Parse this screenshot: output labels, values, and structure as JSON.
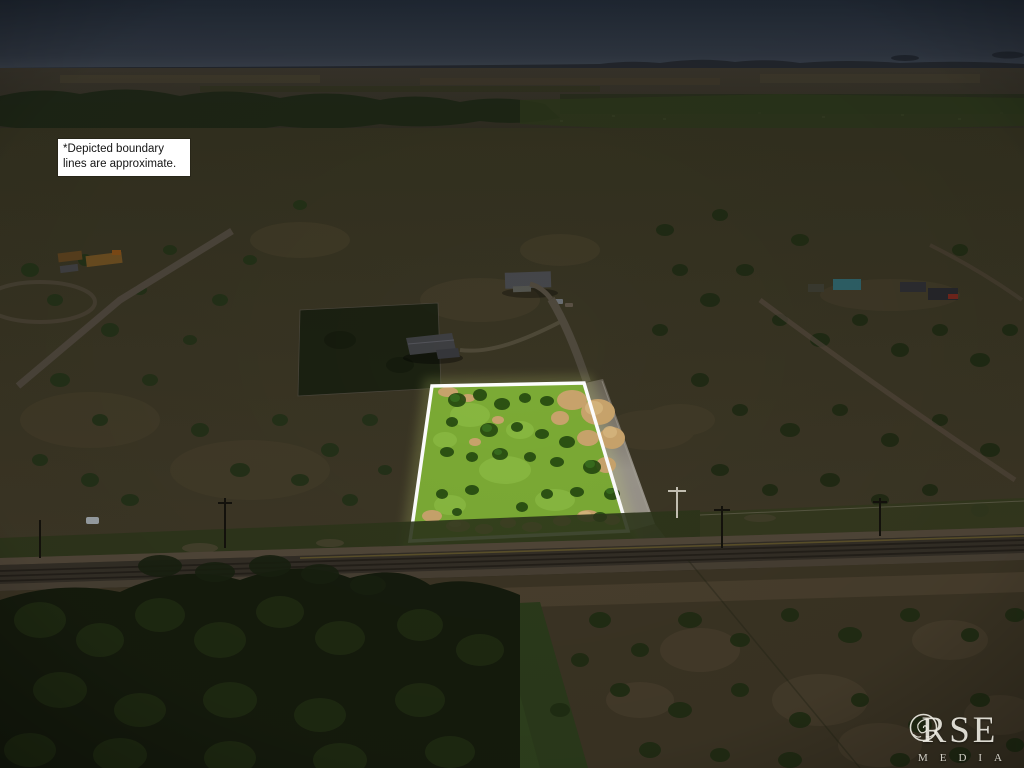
{
  "disclaimer": {
    "line1": "*Depicted boundary",
    "line2": "lines are approximate."
  },
  "logo": {
    "word": "ROSE",
    "prefix": "R",
    "suffix": "SE",
    "subtitle": "MEDIA",
    "rose_icon": "rose-flower-spiral"
  },
  "colors": {
    "boundary": "#ffffff",
    "parcel_grass": "#7cab35",
    "parcel_dirt": "#c9a76e",
    "lit_road": "#95917f",
    "sky_top": "#202833",
    "sky_horizon": "#3a414b",
    "dark_overlay_ground": "#33301f",
    "foreground_trees": "#151b0d",
    "logo_text": "#f1eee5",
    "disclaimer_bg": "#ffffff",
    "disclaimer_text": "#141414"
  }
}
